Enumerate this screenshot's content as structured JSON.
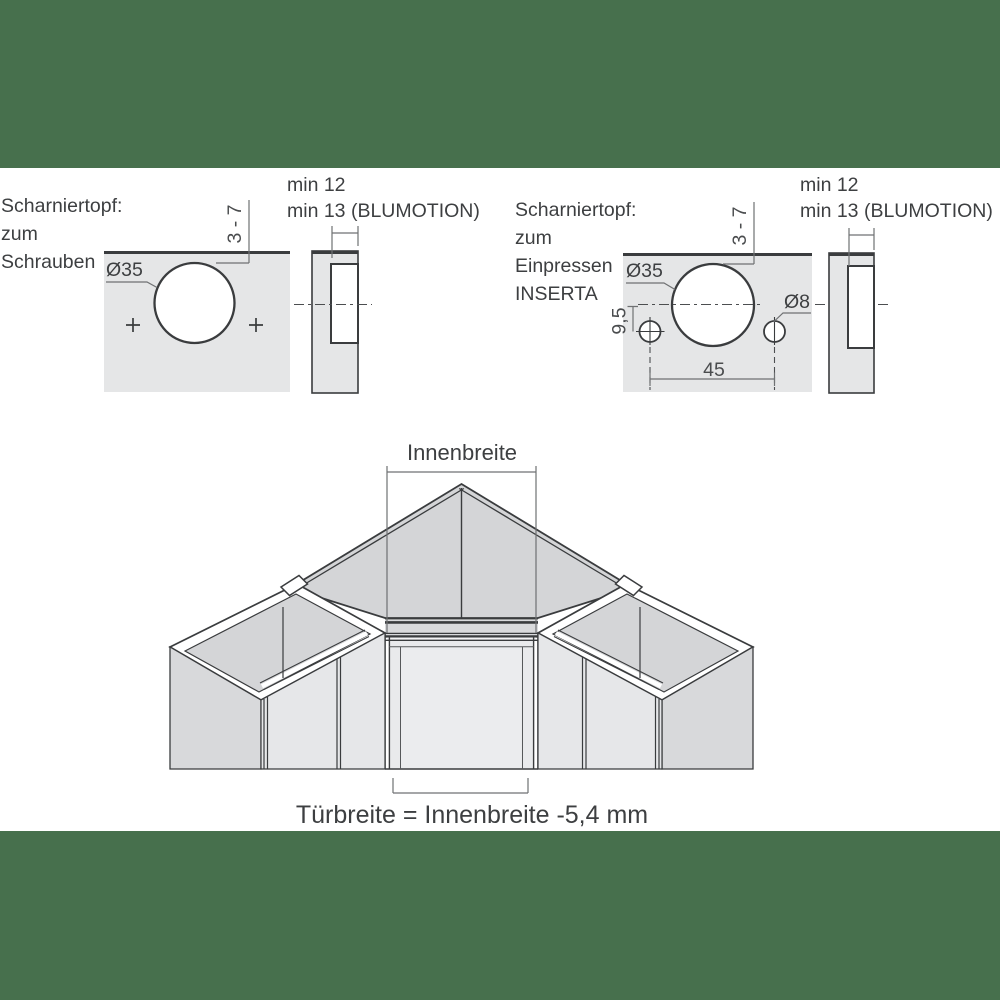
{
  "page": {
    "background_color": "#47704d",
    "canvas_color": "#ffffff",
    "line_color": "#3a3c3e",
    "panel_fill": "#e5e6e7"
  },
  "left_diagram": {
    "title_lines": [
      "Scharniertopf:",
      "zum",
      "Schrauben"
    ],
    "cup_diameter_label": "Ø35",
    "edge_distance_label": "3 - 7",
    "depth_note_line1": "min 12",
    "depth_note_line2": "min 13 (BLUMOTION)"
  },
  "right_diagram": {
    "title_lines": [
      "Scharniertopf:",
      "zum",
      "Einpressen",
      "INSERTA"
    ],
    "cup_diameter_label": "Ø35",
    "edge_distance_label": "3 - 7",
    "dowel_diameter_label": "Ø8",
    "vertical_offset_label": "9,5",
    "hole_spacing_label": "45",
    "depth_note_line1": "min 12",
    "depth_note_line2": "min 13 (BLUMOTION)"
  },
  "cabinet_diagram": {
    "inner_width_label": "Innenbreite",
    "door_width_formula": "Türbreite = Innenbreite -5,4 mm"
  }
}
